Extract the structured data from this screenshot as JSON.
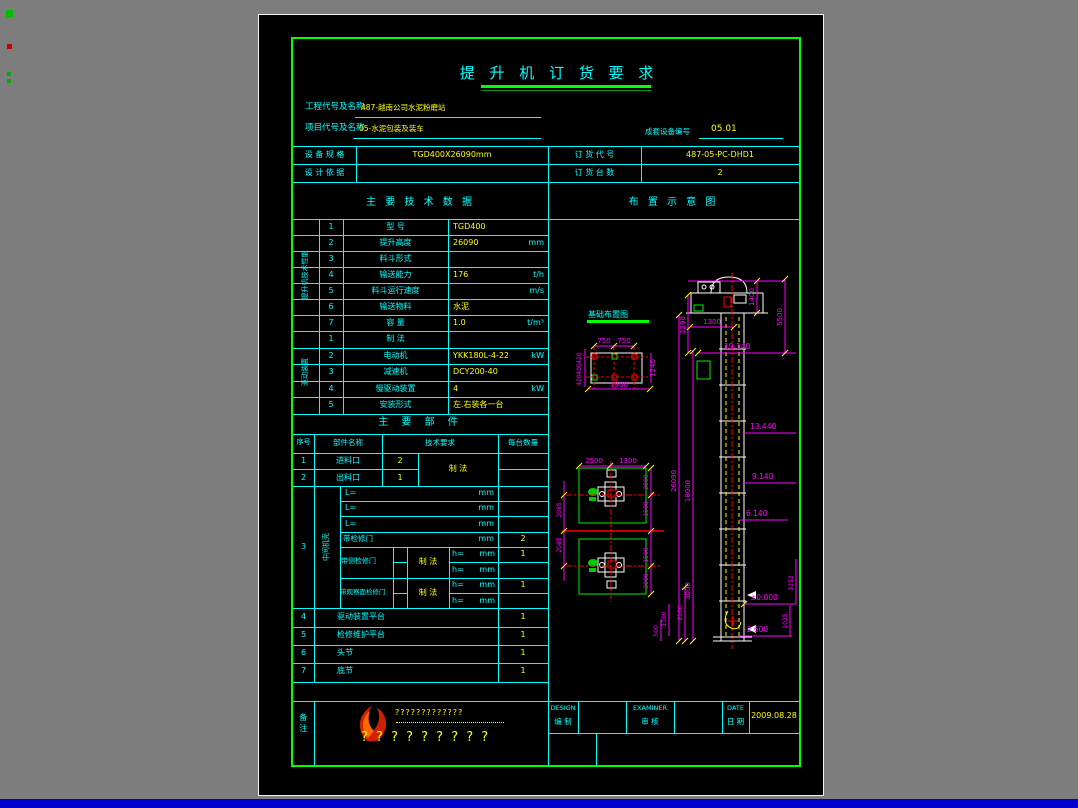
{
  "window": {
    "background": "#7d7d7d",
    "canvas_bg": "#000000",
    "frame_color": "#00ff00",
    "line_color": "#00ffff",
    "value_color": "#ffff00",
    "dim_color": "#ff00ff",
    "bottom_bar_color": "#0000cd"
  },
  "title": "提 升 机 订 货 要 求",
  "header": {
    "project_label": "工程代号及名称",
    "project_value": "487-越南公司水泥粉磨站",
    "item_label": "项目代号及名称",
    "item_value": "05-水泥包装及装车",
    "set_no_label": "成套设备编号",
    "set_no_value": "05.01",
    "spec_label": "设 备 规 格",
    "spec_value": "TGD400X26090mm",
    "order_label": "订 货 代 号",
    "order_value": "487-05-PC-DHD1",
    "basis_label": "设 计 依 据",
    "basis_value": "",
    "qty_label": "订 货 台 数",
    "qty_value": "2"
  },
  "sections": {
    "tech": "主 要 技 术 数 据",
    "layout": "布 置 示 意 图",
    "parts": "主 要 部 件"
  },
  "tech": {
    "group_a_label": "提升机技术性能",
    "a": [
      {
        "no": "1",
        "name": "型    号",
        "value": "TGD400",
        "unit": ""
      },
      {
        "no": "2",
        "name": "提升高度",
        "value": "26090",
        "unit": "mm"
      },
      {
        "no": "3",
        "name": "料斗形式",
        "value": "",
        "unit": ""
      },
      {
        "no": "4",
        "name": "输送能力",
        "value": "176",
        "unit": "t/h"
      },
      {
        "no": "5",
        "name": "料斗运行速度",
        "value": "",
        "unit": "m/s"
      },
      {
        "no": "6",
        "name": "输送物料",
        "value": "水泥",
        "unit": ""
      },
      {
        "no": "7",
        "name": "容  量",
        "value": "1.0",
        "unit": "t/m³"
      }
    ],
    "group_b_label": "驱动装置",
    "b": [
      {
        "no": "1",
        "name": "制  法",
        "value": "",
        "unit": ""
      },
      {
        "no": "2",
        "name": "电动机",
        "value": "YKK180L-4-22",
        "unit": "kW"
      },
      {
        "no": "3",
        "name": "减速机",
        "value": "DCY200-40",
        "unit": ""
      },
      {
        "no": "4",
        "name": "慢驱动装置",
        "value": "4",
        "unit": "kW"
      },
      {
        "no": "5",
        "name": "安装形式",
        "value": "左.右装各一台",
        "unit": ""
      }
    ]
  },
  "parts": {
    "headers": {
      "no": "序号",
      "name": "部件名称",
      "req": "技术要求",
      "qty": "每台数量"
    },
    "row1": {
      "no": "1",
      "name": "进料口",
      "count": "2",
      "req": "制 法"
    },
    "row2": {
      "no": "2",
      "name": "出料口",
      "count": "1"
    },
    "row3": {
      "no": "3",
      "group": "中间机壳",
      "l_prefix": "L=",
      "l_unit": "mm",
      "door": {
        "name": "带检修门",
        "unit": "mm",
        "qty": "2"
      },
      "side": {
        "name": "带侧检修门",
        "req": "制 法",
        "h": "h=",
        "unit": "mm",
        "qty": "1"
      },
      "face": {
        "name": "带观察面检修门",
        "req": "制 法",
        "h": "h=",
        "unit": "mm",
        "qty": "1"
      }
    },
    "row4": {
      "no": "4",
      "name": "驱动装置平台",
      "qty": "1"
    },
    "row5": {
      "no": "5",
      "name": "检修维护平台",
      "qty": "1"
    },
    "row6": {
      "no": "6",
      "name": "头节",
      "qty": "1"
    },
    "row7": {
      "no": "7",
      "name": "底节",
      "qty": "1"
    },
    "remark_label": "备注",
    "remark_line1": "?????????????",
    "remark_line2": "? ? ? ? ? ? ? ? ?"
  },
  "titleblock": {
    "design_en": "DESIGN",
    "design_cn": "编 制",
    "examiner_en": "EXAMINER",
    "examiner_cn": "审 核",
    "date_en": "DATE",
    "date_cn": "日 期",
    "date_value": "2009.08.28"
  },
  "diagram": {
    "foundation": {
      "title": "基础布置图",
      "d750a": "750",
      "d750b": "750",
      "d1900": "1900",
      "d1240": "1240",
      "d420a": "420",
      "d400": "400",
      "d420b": "420"
    },
    "elevation": {
      "e2290": "2290",
      "e1300": "1300",
      "e1400": "1400",
      "e5500": "5500",
      "lvl19": "19.140",
      "e26090": "26090",
      "e18000": "18000",
      "lvl13": "13.440",
      "lvl9": "9.140",
      "lvl6": "6.140",
      "e3000": "3000",
      "lvl0": "±0.000",
      "e3252": "3252",
      "e2100": "2100",
      "e1100": "1100",
      "e500": "500",
      "lvlm": "-2.600",
      "e1025": "1025"
    },
    "plan": {
      "p2500": "2500",
      "p1300": "1300",
      "pr2000a": "2000",
      "pr1500a": "1500",
      "pr1500b": "1500",
      "pr2000b": "2000",
      "pl2085a": "2085",
      "pl2085b": "2085"
    }
  }
}
